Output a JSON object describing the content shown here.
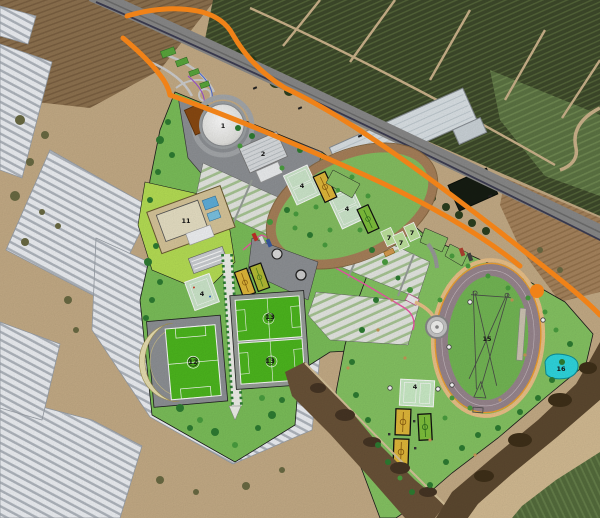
{
  "scene": {
    "type": "aerial-photo-with-sports-complex-master-plan",
    "width": 600,
    "height": 518
  },
  "labels": [
    {
      "text": "1",
      "x": 223,
      "y": 128
    },
    {
      "text": "2",
      "x": 263,
      "y": 156
    },
    {
      "text": "4",
      "x": 302,
      "y": 188
    },
    {
      "text": "4",
      "x": 347,
      "y": 211
    },
    {
      "text": "4",
      "x": 202,
      "y": 296
    },
    {
      "text": "4",
      "x": 415,
      "y": 389
    },
    {
      "text": "7",
      "x": 389,
      "y": 240
    },
    {
      "text": "7",
      "x": 401,
      "y": 245
    },
    {
      "text": "7",
      "x": 412,
      "y": 235
    },
    {
      "text": "11",
      "x": 186,
      "y": 223
    },
    {
      "text": "12",
      "x": 193,
      "y": 364
    },
    {
      "text": "13",
      "x": 270,
      "y": 319
    },
    {
      "text": "13",
      "x": 270,
      "y": 363
    },
    {
      "text": "15",
      "x": 487,
      "y": 341
    },
    {
      "text": "16",
      "x": 561,
      "y": 371
    }
  ],
  "colors": {
    "road_overlay_orange": "#f08218",
    "park_green": "#7cc05a",
    "park_green_right": "#86c563",
    "pitch_green": "#4db81e",
    "court_yellow": "#e2b93a",
    "court_small_green": "#7fc13c",
    "tennis_pale_green": "#cfe9cd",
    "athletics_track_mauve": "#99878f",
    "cycle_track_tan": "#a8815a",
    "pond_cyan": "#2fd8e0",
    "path_pink": "#ee58a8",
    "path_tan": "#ecc289",
    "plaza_gray": "#8f9296",
    "pool_deck_tan": "#d9c79b",
    "greenhouse_white": "#e6e9ed",
    "orchard_dark": "#3e4a2b",
    "soil_tan": "#c6ad87"
  }
}
